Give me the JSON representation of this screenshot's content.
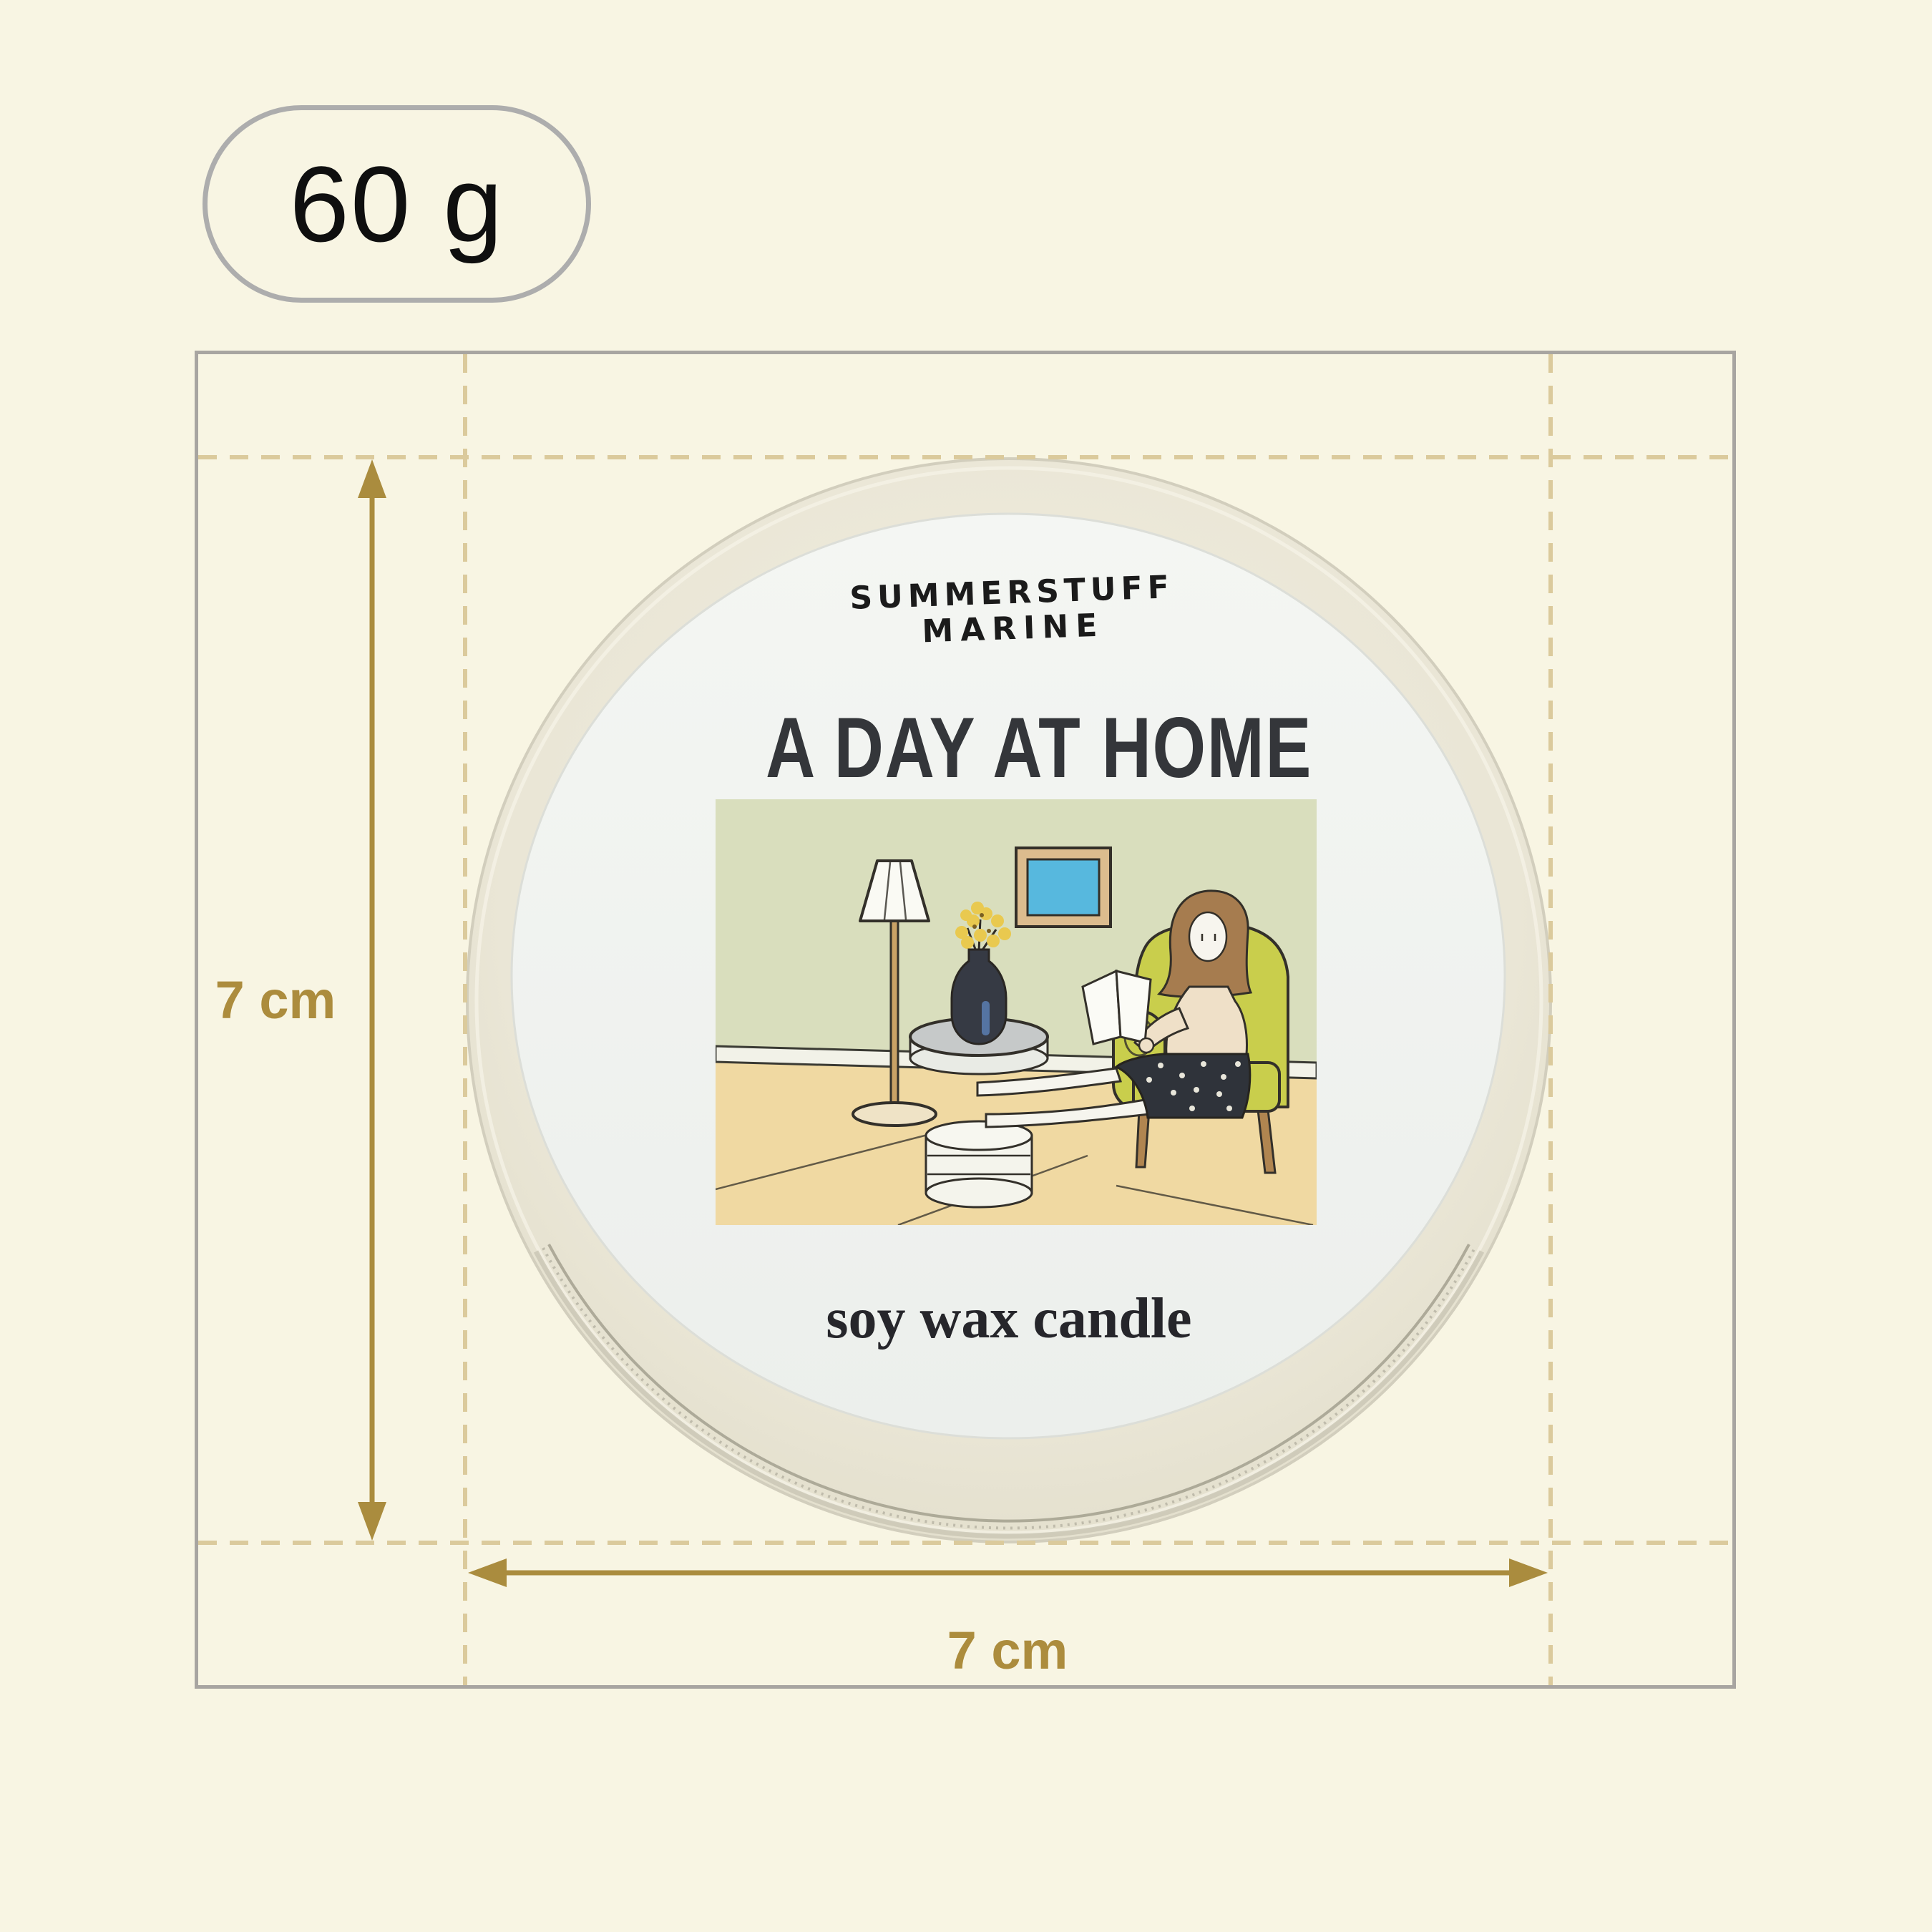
{
  "badge": {
    "weight": "60 g"
  },
  "dimensions": {
    "height_label": "7 cm",
    "width_label": "7 cm"
  },
  "tin": {
    "brand_line1": "SUMMERSTUFF",
    "brand_line2": "MARINE",
    "title": "A DAY AT HOME",
    "subtitle": "soy wax candle"
  },
  "colors": {
    "background": "#F8F5E3",
    "frame_gray": "#A8A5A1",
    "badge_border": "#ADADAD",
    "dashed_guide": "#DBCA9C",
    "accent_gold": "#AC8C3D",
    "tin_body": "#EAE6D6",
    "label_bg": "#F1F3F0",
    "wall_green": "#D9DEBD",
    "floor_tan": "#F0D9A2",
    "armchair_yellow": "#C9CE4C",
    "picture_blue": "#57B8DE",
    "vase_navy": "#363A44",
    "flower_yellow": "#E9C94F"
  },
  "illustration_scene": {
    "elements": [
      "floor-lamp",
      "picture-frame",
      "side-table",
      "flower-vase",
      "book-stack",
      "woman-reading",
      "open-book",
      "armchair"
    ]
  }
}
